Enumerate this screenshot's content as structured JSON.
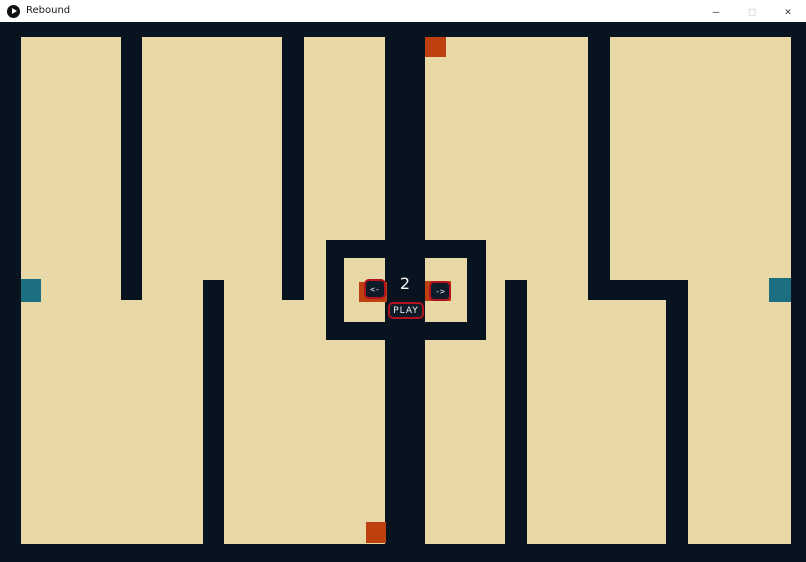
{
  "window": {
    "title": "Rebound",
    "controls": {
      "minimize": "–",
      "maximize": "□",
      "close": "✕"
    }
  },
  "hud": {
    "level": "2",
    "prev_label": "<-",
    "next_label": "->",
    "play_label": "PLAY"
  },
  "colors": {
    "dark": "#071420",
    "tan": "#e9d8a7",
    "orange": "#bf400f",
    "teal": "#1b6f80",
    "red": "#b1121f",
    "btnfill": "#0d1c28"
  },
  "maze": {
    "field": {
      "name": "maze-field",
      "x": 21,
      "y": 15,
      "w": 770,
      "h": 507,
      "color": "tan"
    },
    "walls": [
      {
        "name": "center-corridor",
        "x": 385,
        "y": 0,
        "w": 40,
        "h": 540,
        "color": "dark"
      },
      {
        "name": "wall-top-left",
        "x": 121,
        "y": 0,
        "w": 21,
        "h": 278,
        "color": "dark"
      },
      {
        "name": "wall-top-mid-left",
        "x": 282,
        "y": 0,
        "w": 22,
        "h": 278,
        "color": "dark"
      },
      {
        "name": "wall-top-right",
        "x": 588,
        "y": 0,
        "w": 22,
        "h": 278,
        "color": "dark"
      },
      {
        "name": "wall-bottom-left",
        "x": 203,
        "y": 258,
        "w": 21,
        "h": 282,
        "color": "dark"
      },
      {
        "name": "wall-bottom-mid-right",
        "x": 505,
        "y": 258,
        "w": 22,
        "h": 282,
        "color": "dark"
      },
      {
        "name": "wall-jog-right",
        "x": 588,
        "y": 258,
        "w": 100,
        "h": 20,
        "color": "dark"
      },
      {
        "name": "wall-bottom-right",
        "x": 666,
        "y": 258,
        "w": 22,
        "h": 282,
        "color": "dark"
      },
      {
        "name": "center-box",
        "x": 326,
        "y": 218,
        "w": 160,
        "h": 100,
        "color": "dark"
      },
      {
        "name": "center-box-window-left",
        "x": 344,
        "y": 236,
        "w": 41,
        "h": 64,
        "color": "tan"
      },
      {
        "name": "center-box-window-right",
        "x": 425,
        "y": 236,
        "w": 42,
        "h": 64,
        "color": "tan"
      }
    ],
    "objects": [
      {
        "name": "orange-square-top",
        "x": 425,
        "y": 15,
        "w": 21,
        "h": 20,
        "color": "orange"
      },
      {
        "name": "orange-square-bottom",
        "x": 366,
        "y": 500,
        "w": 20,
        "h": 21,
        "color": "orange"
      },
      {
        "name": "teal-square-left",
        "x": 21,
        "y": 257,
        "w": 20,
        "h": 23,
        "color": "teal"
      },
      {
        "name": "teal-square-right",
        "x": 769,
        "y": 256,
        "w": 22,
        "h": 24,
        "color": "teal"
      },
      {
        "name": "orange-pad-left",
        "x": 359,
        "y": 260,
        "w": 28,
        "h": 20,
        "color": "orange"
      },
      {
        "name": "orange-pad-right",
        "x": 425,
        "y": 259,
        "w": 26,
        "h": 20,
        "color": "orange"
      }
    ]
  }
}
